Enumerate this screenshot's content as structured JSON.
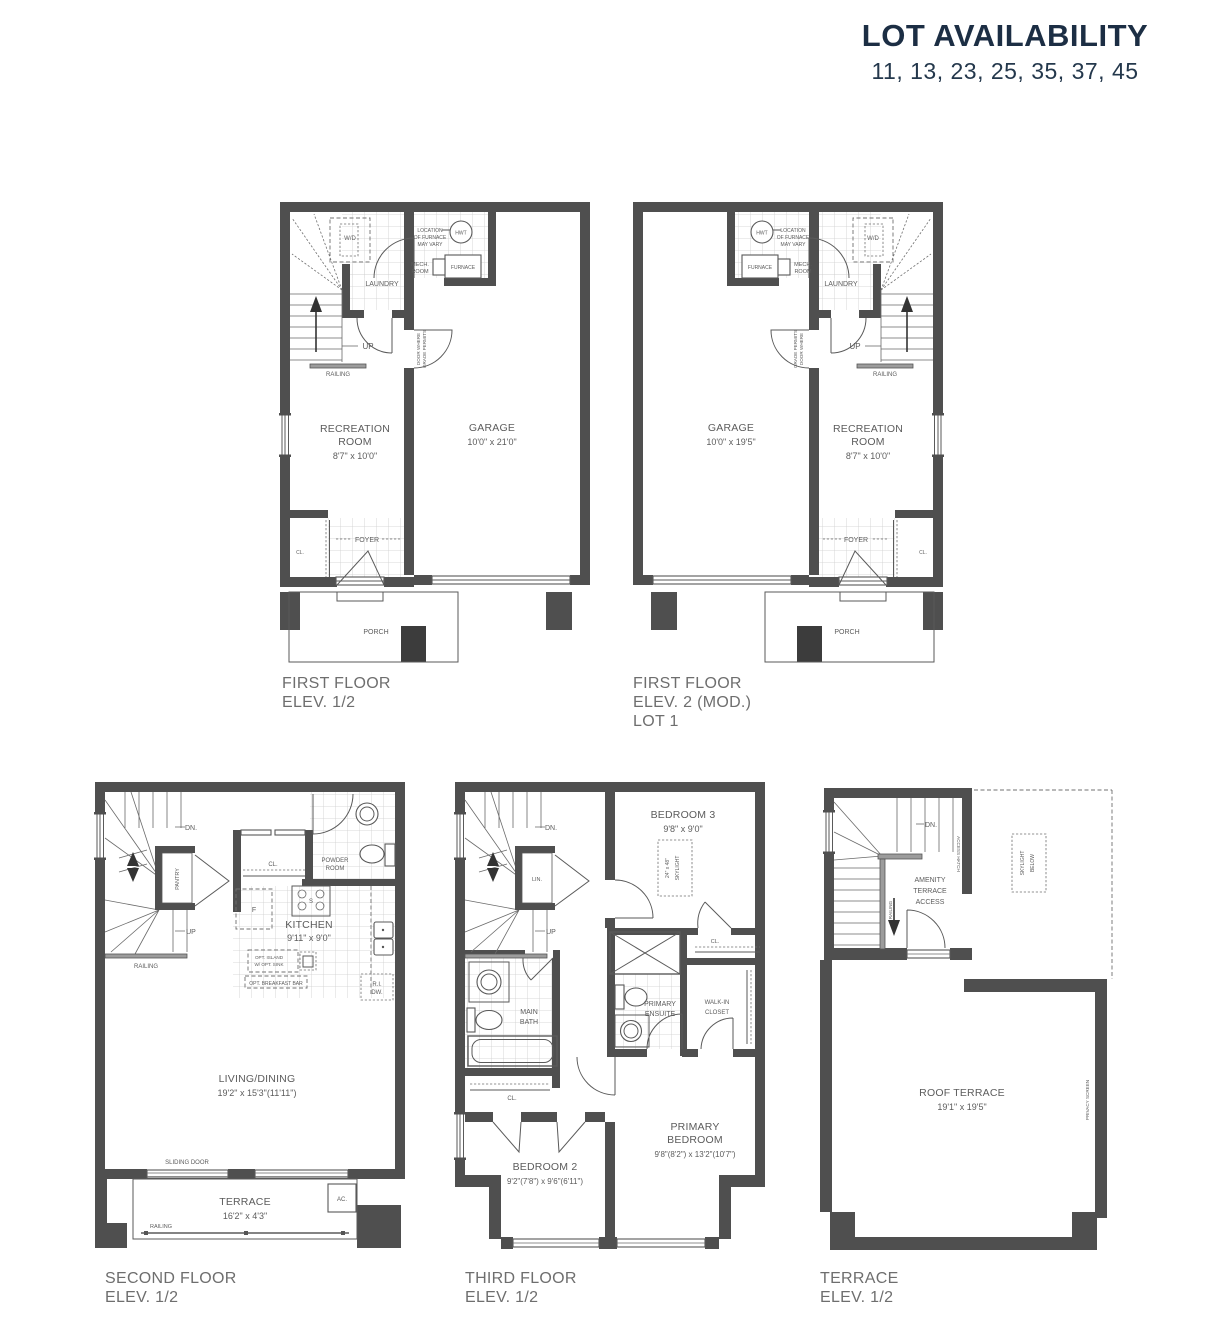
{
  "header": {
    "title": "LOT AVAILABILITY",
    "lots": "11, 13, 23, 25, 35, 37, 45"
  },
  "colors": {
    "accent_navy": "#1c2e44",
    "wall_gray": "#4f4f4f",
    "caption_gray": "#6e6e6e",
    "line_gray": "#5a5a5a"
  },
  "plans": {
    "ff1": {
      "caption1": "FIRST FLOOR",
      "caption2": "ELEV. 1/2",
      "labels": {
        "wd": "W/D",
        "note1": "LOCATION",
        "note2": "OF FURNACE",
        "note3": "MAY VARY",
        "hwt": "HWT",
        "mech1": "MECH.",
        "mech2": "ROOM",
        "furnace": "FURNACE",
        "laundry": "LAUNDRY",
        "up": "UP",
        "railing": "RAILING",
        "grade1": "DOOR WHERE",
        "grade2": "GRADE PERMITS",
        "rec1": "RECREATION",
        "rec2": "ROOM",
        "rec_dim": "8'7\" x 10'0\"",
        "garage": "GARAGE",
        "garage_dim": "10'0\" x 21'0\"",
        "cl": "CL.",
        "foyer": "FOYER",
        "porch": "PORCH"
      }
    },
    "ff2": {
      "caption1": "FIRST FLOOR",
      "caption2": "ELEV. 2 (MOD.)",
      "caption3": "LOT 1",
      "labels": {
        "wd": "W/D",
        "note1": "LOCATION",
        "note2": "OF FURNACE",
        "note3": "MAY VARY",
        "hwt": "HWT",
        "mech1": "MECH.",
        "mech2": "ROOM",
        "furnace": "FURNACE",
        "laundry": "LAUNDRY",
        "up": "UP",
        "railing": "RAILING",
        "grade1": "DOOR WHERE",
        "grade2": "GRADE PERMITS",
        "rec1": "RECREATION",
        "rec2": "ROOM",
        "rec_dim": "8'7\" x 10'0\"",
        "garage": "GARAGE",
        "garage_dim": "10'0\" x 19'5\"",
        "cl": "CL.",
        "foyer": "FOYER",
        "porch": "PORCH"
      }
    },
    "sf": {
      "caption1": "SECOND FLOOR",
      "caption2": "ELEV. 1/2",
      "labels": {
        "dn": "DN.",
        "pantry": "PANTRY",
        "up": "UP",
        "railing": "RAILING",
        "cl": "CL.",
        "powder1": "POWDER",
        "powder2": "ROOM",
        "fridge": "F",
        "stove": "S",
        "kitchen": "KITCHEN",
        "kitchen_dim": "9'11\" x 9'0\"",
        "island1": "OPT. ISLAND",
        "island2": "W/ OPT. SINK",
        "breakfast": "OPT. BREAKFAST BAR",
        "ri": "R.I.",
        "dw": "DW.",
        "living": "LIVING/DINING",
        "living_dim": "19'2\" x 15'3\"(11'11\")",
        "sliding": "SLIDING DOOR",
        "terrace": "TERRACE",
        "terrace_dim": "16'2\" x 4'3\"",
        "ac": "AC.",
        "railing2": "RAILING"
      }
    },
    "tf": {
      "caption1": "THIRD FLOOR",
      "caption2": "ELEV. 1/2",
      "labels": {
        "dn": "DN.",
        "lin": "LIN.",
        "up": "UP",
        "bed3": "BEDROOM 3",
        "bed3_dim": "9'8\" x 9'0\"",
        "sky1": "24\" x 48\"",
        "sky2": "SKYLIGHT",
        "cl_bed3": "CL.",
        "main1": "MAIN",
        "main2": "BATH",
        "ens1": "PRIMARY",
        "ens2": "ENSUITE",
        "wic1": "WALK-IN",
        "wic2": "CLOSET",
        "cl_hall": "CL.",
        "bed2": "BEDROOM 2",
        "bed2_dim": "9'2\"(7'8\") x 9'6\"(6'11\")",
        "pbr1": "PRIMARY",
        "pbr2": "BEDROOM",
        "pbr_dim": "9'8\"(8'2\") x 13'2\"(10'7\")"
      }
    },
    "ter": {
      "caption1": "TERRACE",
      "caption2": "ELEV. 1/2",
      "labels": {
        "dn": "DN.",
        "access": "ACCESS HATCH",
        "railing": "RAILING",
        "am1": "AMENITY",
        "am2": "TERRACE",
        "am3": "ACCESS",
        "sky1": "SKYLIGHT",
        "sky2": "BELOW",
        "roof": "ROOF TERRACE",
        "roof_dim": "19'1\" x 19'5\"",
        "privacy": "PRIVACY SCREEN"
      }
    }
  }
}
